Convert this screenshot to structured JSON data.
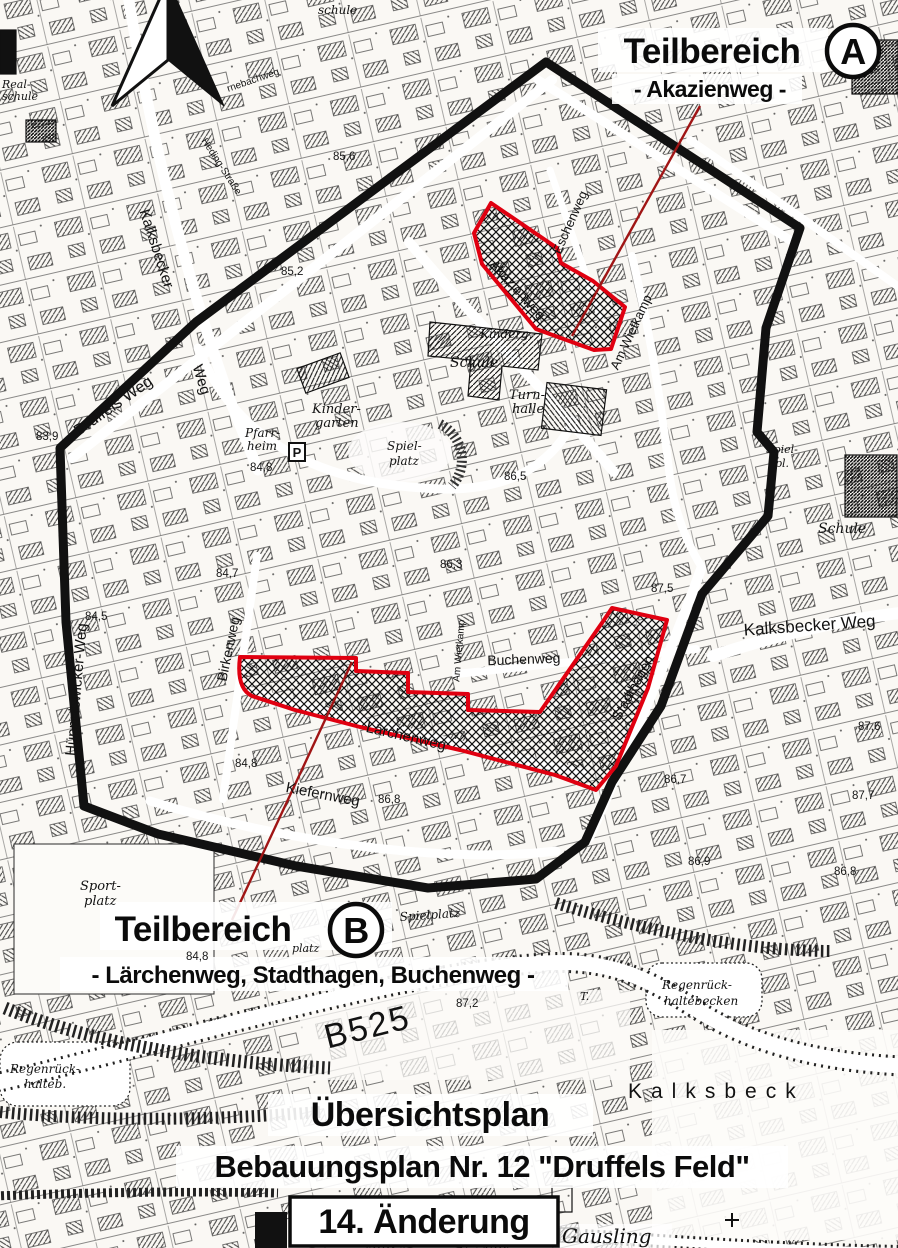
{
  "map": {
    "teilbereich_a": {
      "title": "Teilbereich",
      "badge": "A",
      "subtitle": "- Akazienweg -"
    },
    "teilbereich_b": {
      "title": "Teilbereich",
      "badge": "B",
      "subtitle": "- Lärchenweg, Stadthagen, Buchenweg -"
    },
    "title_block": {
      "line1": "Übersichtsplan",
      "line2": "Bebauungsplan Nr. 12 \"Druffels Feld\"",
      "revision": "14. Änderung"
    },
    "streets": {
      "kalksbecker_nw": "Kalksbecker",
      "kalksbecker_nw_weg": "Weg",
      "druffels_weg": "Druffels Weg",
      "hueppelswicker_weg": "Hüppelswicker-Weg",
      "birkenweg": "Birkenweg",
      "buchenweg": "Buchenweg",
      "laerchenweg": "Lärchenweg",
      "kiefernweg": "Kiefernweg",
      "stadthagen": "Stadthagen",
      "akazienweg": "Akazienweg",
      "eschenweg": "Eschenweg",
      "am_wietkamp": "Am Wietkamp",
      "am_wietkamp_2": "Am Wietkamp",
      "kalksbecker_weg_e": "Kalksbecker Weg",
      "b525": "B525",
      "heding_strasse": "Heding-Straße",
      "rnebachweg": "rnebachweg"
    },
    "places": {
      "kalksbeck": "Kalksbeck",
      "gausling": "Gausling",
      "realschule": [
        "Real-",
        "schule"
      ],
      "schule_top": "schule",
      "schule": "Schule",
      "schule_e": "Schule",
      "kinderg": "Kinderg.",
      "kindergarten": [
        "Kinder-",
        "garten"
      ],
      "turnhalle": [
        "Turn-",
        "halle"
      ],
      "pfarrheim": [
        "Pfarr-",
        "heim"
      ],
      "parking": "P",
      "spielplatz": [
        "Spiel-",
        "platz"
      ],
      "spielplatz_b": "Spielplatz",
      "spielplatz_e": [
        "Spiel-",
        "pl."
      ],
      "platz_fragment": "platz",
      "sportplatz": [
        "Sport-",
        "platz"
      ],
      "regenbecken_w": [
        "Regenrück-",
        "halteb."
      ],
      "regenbecken_e": [
        "Regenrück-",
        "haltebecken"
      ],
      "t_marker": "T."
    },
    "elevations": [
      "85,6",
      "85,2",
      "83,9",
      "84,8",
      "86,5",
      "84,7",
      "86,3",
      "87,5",
      "84,5",
      "84,8",
      "86,8",
      "86,7",
      "87,6",
      "87,7",
      "86,9",
      "86,8",
      "87,2",
      "84,8"
    ],
    "colors": {
      "boundary": "#111111",
      "area_outline": "#e00010",
      "leader_line": "#a01515"
    }
  }
}
